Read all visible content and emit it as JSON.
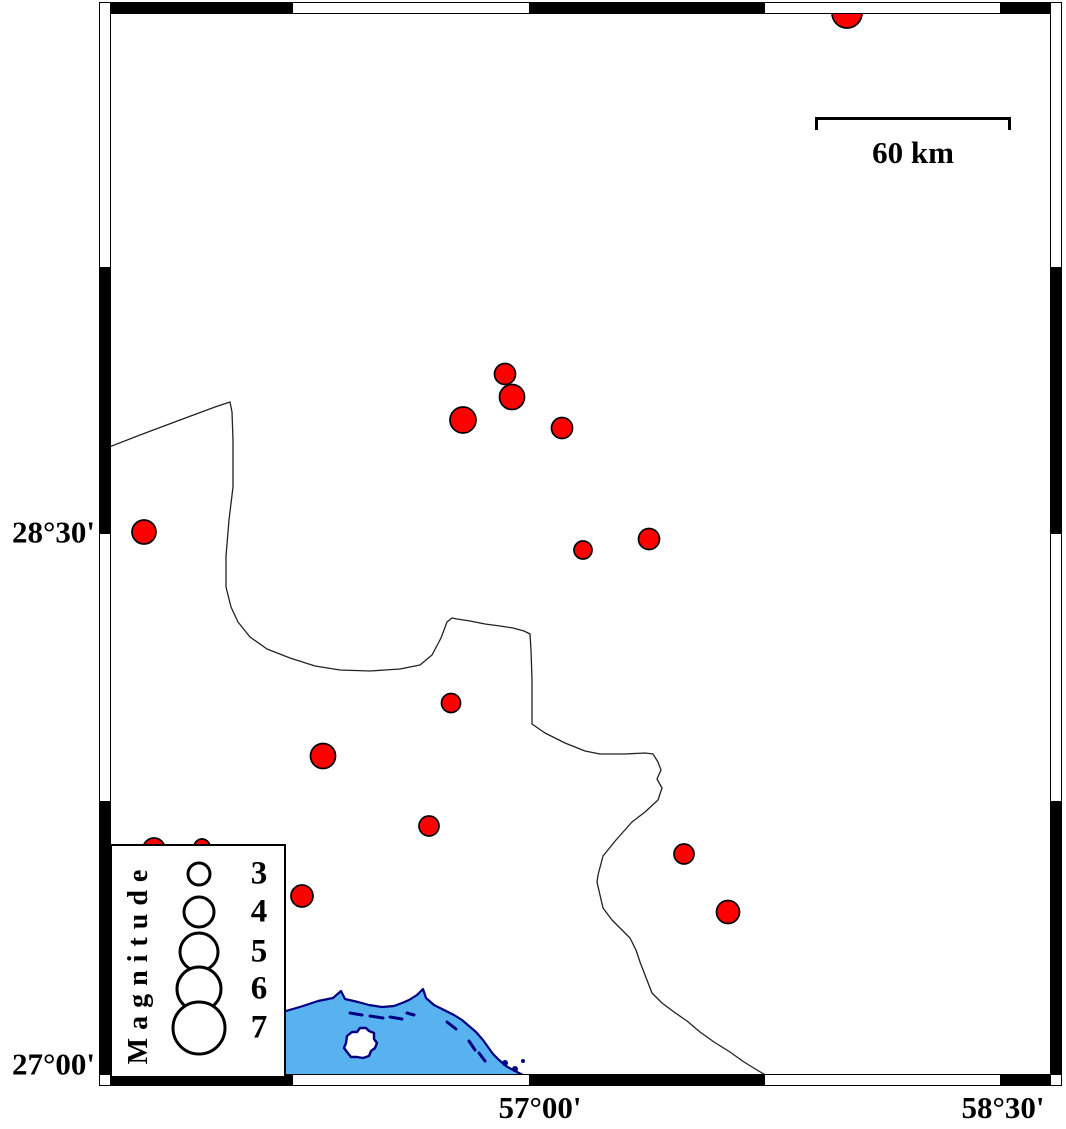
{
  "scale_bar": {
    "label": "60 km"
  },
  "legend": {
    "title": "Magnitude",
    "circle_cx": 198,
    "number_cx": 257,
    "entries": [
      {
        "label": "3",
        "y": 873,
        "radius": 11
      },
      {
        "label": "4",
        "y": 911,
        "radius": 15
      },
      {
        "label": "5",
        "y": 951,
        "radius": 19
      },
      {
        "label": "6",
        "y": 988,
        "radius": 22
      },
      {
        "label": "7",
        "y": 1027,
        "radius": 26
      }
    ]
  },
  "axes": {
    "left_labels": [
      {
        "text": "28°30'",
        "y": 532
      },
      {
        "text": "27°00'",
        "y": 1064
      }
    ],
    "bottom_labels": [
      {
        "text": "57°00'",
        "x": 540
      },
      {
        "text": "58°30'",
        "x": 1003
      }
    ]
  },
  "colors": {
    "epicenter_fill": "#ff0000",
    "epicenter_outline": "#000000",
    "sea_fill": "#58b2f0",
    "coast_outline": "#000080",
    "boundary_line": "#222222",
    "frame_black": "#000000",
    "frame_white": "#ffffff"
  },
  "frame": {
    "outer": [
      99,
      2,
      1062,
      1086
    ],
    "inner": [
      110,
      13,
      1051,
      1075
    ],
    "x_transitions": [
      293,
      529,
      765,
      1000
    ],
    "y_transitions": [
      267,
      534,
      801
    ],
    "x_first_black": true,
    "y_first_black": false
  },
  "map_data": {
    "earthquakes": [
      [
        847,
        13,
        15
      ],
      [
        144,
        532,
        12
      ],
      [
        505,
        374,
        10.5
      ],
      [
        512,
        397,
        12.5
      ],
      [
        463,
        420,
        13
      ],
      [
        562,
        428,
        10.5
      ],
      [
        583,
        550,
        9
      ],
      [
        649,
        539,
        10.5
      ],
      [
        451,
        703,
        9.5
      ],
      [
        323,
        756,
        12.5
      ],
      [
        429,
        826,
        10
      ],
      [
        684,
        854,
        10
      ],
      [
        728,
        912,
        11.5
      ],
      [
        302,
        896,
        11
      ],
      [
        154,
        849,
        11
      ],
      [
        202,
        847,
        8
      ]
    ],
    "boundary_line": [
      [
        104,
        449
      ],
      [
        140,
        435
      ],
      [
        180,
        420
      ],
      [
        215,
        407
      ],
      [
        230,
        402
      ],
      [
        232,
        412
      ],
      [
        233,
        440
      ],
      [
        233,
        487
      ],
      [
        229,
        520
      ],
      [
        226,
        556
      ],
      [
        226,
        587
      ],
      [
        231,
        607
      ],
      [
        238,
        622
      ],
      [
        250,
        637
      ],
      [
        267,
        649
      ],
      [
        290,
        658
      ],
      [
        315,
        666
      ],
      [
        340,
        670
      ],
      [
        370,
        671
      ],
      [
        400,
        669
      ],
      [
        420,
        665
      ],
      [
        432,
        655
      ],
      [
        441,
        638
      ],
      [
        447,
        622
      ],
      [
        452,
        618
      ],
      [
        457,
        619
      ],
      [
        470,
        621
      ],
      [
        485,
        624
      ],
      [
        500,
        626
      ],
      [
        513,
        628
      ],
      [
        524,
        631
      ],
      [
        530,
        634
      ],
      [
        531,
        650
      ],
      [
        532,
        680
      ],
      [
        532,
        724
      ],
      [
        545,
        733
      ],
      [
        565,
        743
      ],
      [
        585,
        751
      ],
      [
        600,
        754
      ],
      [
        625,
        754
      ],
      [
        645,
        753
      ],
      [
        653,
        754
      ],
      [
        658,
        762
      ],
      [
        661,
        770
      ],
      [
        657,
        779
      ],
      [
        662,
        788
      ],
      [
        658,
        800
      ],
      [
        645,
        812
      ],
      [
        632,
        822
      ],
      [
        616,
        840
      ],
      [
        603,
        856
      ],
      [
        598,
        875
      ],
      [
        597,
        882
      ],
      [
        600,
        895
      ],
      [
        603,
        908
      ],
      [
        612,
        920
      ],
      [
        622,
        930
      ],
      [
        630,
        938
      ],
      [
        636,
        950
      ],
      [
        640,
        962
      ],
      [
        645,
        975
      ],
      [
        652,
        993
      ],
      [
        662,
        1003
      ],
      [
        674,
        1012
      ],
      [
        687,
        1021
      ],
      [
        700,
        1032
      ],
      [
        714,
        1042
      ],
      [
        730,
        1052
      ],
      [
        744,
        1062
      ],
      [
        757,
        1070
      ],
      [
        772,
        1079
      ]
    ],
    "coastline": [
      [
        250,
        1022
      ],
      [
        268,
        1016
      ],
      [
        286,
        1011
      ],
      [
        303,
        1006
      ],
      [
        318,
        1001
      ],
      [
        333,
        998
      ],
      [
        341,
        991
      ],
      [
        345,
        999
      ],
      [
        358,
        1002
      ],
      [
        369,
        1005
      ],
      [
        382,
        1007
      ],
      [
        394,
        1006
      ],
      [
        402,
        1003
      ],
      [
        409,
        1000
      ],
      [
        417,
        995
      ],
      [
        423,
        989
      ],
      [
        426,
        998
      ],
      [
        434,
        1005
      ],
      [
        444,
        1010
      ],
      [
        454,
        1015
      ],
      [
        462,
        1020
      ],
      [
        469,
        1026
      ],
      [
        476,
        1032
      ],
      [
        483,
        1040
      ],
      [
        488,
        1047
      ],
      [
        493,
        1054
      ],
      [
        499,
        1060
      ],
      [
        506,
        1066
      ],
      [
        513,
        1070
      ],
      [
        521,
        1074
      ],
      [
        530,
        1078
      ]
    ],
    "coast_dashes": [
      [
        350,
        1013,
        362,
        1015
      ],
      [
        370,
        1016,
        383,
        1018
      ],
      [
        390,
        1017,
        402,
        1019
      ],
      [
        407,
        1013,
        414,
        1015
      ],
      [
        447,
        1022,
        456,
        1029
      ],
      [
        469,
        1041,
        475,
        1050
      ],
      [
        479,
        1053,
        485,
        1061
      ]
    ],
    "island": [
      [
        346,
        1043
      ],
      [
        347,
        1036
      ],
      [
        352,
        1032
      ],
      [
        357,
        1032
      ],
      [
        360,
        1028
      ],
      [
        366,
        1028
      ],
      [
        369,
        1031
      ],
      [
        374,
        1033
      ],
      [
        374,
        1039
      ],
      [
        377,
        1043
      ],
      [
        375,
        1048
      ],
      [
        371,
        1051
      ],
      [
        369,
        1056
      ],
      [
        363,
        1058
      ],
      [
        357,
        1057
      ],
      [
        351,
        1057
      ],
      [
        347,
        1052
      ],
      [
        344,
        1048
      ]
    ],
    "islets": [
      [
        505,
        1063,
        3
      ],
      [
        515,
        1069,
        3
      ],
      [
        523,
        1061,
        2
      ]
    ]
  }
}
